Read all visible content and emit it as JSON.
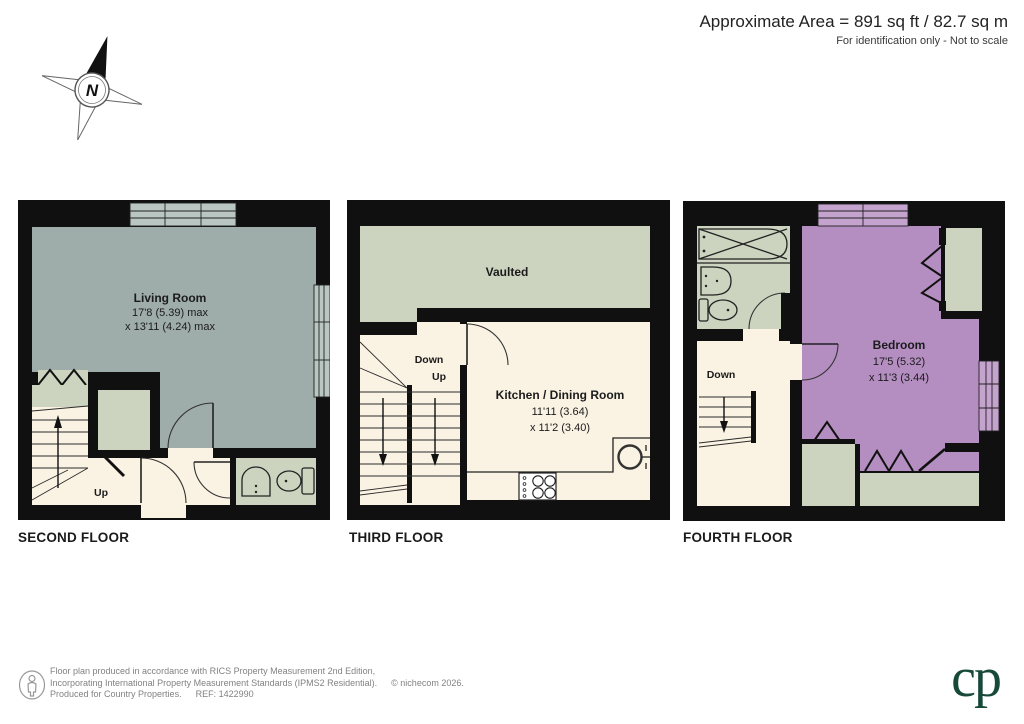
{
  "header": {
    "area": "Approximate Area = 891 sq ft / 82.7 sq m",
    "note": "For identification only - Not to scale"
  },
  "compass": {
    "north": "N"
  },
  "floors": {
    "second": {
      "label": "SECOND FLOOR",
      "room": {
        "name": "Living Room",
        "dim1": "17'8 (5.39) max",
        "dim2": "x 13'11 (4.24) max"
      },
      "up": "Up"
    },
    "third": {
      "label": "THIRD FLOOR",
      "vaulted": "Vaulted",
      "room": {
        "name": "Kitchen / Dining Room",
        "dim1": "11'11 (3.64)",
        "dim2": "x 11'2 (3.40)"
      },
      "down": "Down",
      "up": "Up"
    },
    "fourth": {
      "label": "FOURTH FLOOR",
      "room": {
        "name": "Bedroom",
        "dim1": "17'5 (5.32)",
        "dim2": "x 11'3 (3.44)"
      },
      "down": "Down"
    }
  },
  "footer": {
    "line1": "Floor plan produced in accordance with RICS Property Measurement 2nd Edition,",
    "line2": "Incorporating International Property Measurement Standards (IPMS2 Residential).",
    "copyright": "© nichecom 2026.",
    "line3": "Produced for Country Properties.",
    "ref": "REF: 1422990",
    "logo": "cp"
  },
  "colors": {
    "wall": "#101010",
    "living_gray": "#9fadaa",
    "sage": "#ccd4c0",
    "cream": "#faf3e4",
    "mauve": "#b48ec1",
    "window_gray": "#b9c6c1",
    "window_mauve": "#c5a3cf",
    "logo_green": "#17493a"
  }
}
